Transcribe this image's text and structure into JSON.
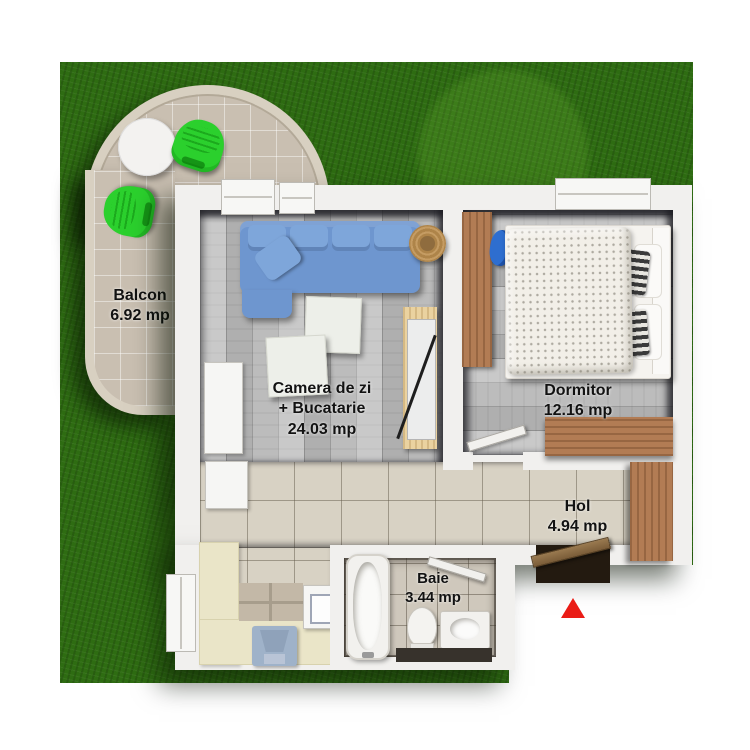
{
  "page": {
    "background": "#ffffff",
    "kind": "apartment floor plan, top-down render"
  },
  "rooms": {
    "balcon": {
      "label": "Balcon",
      "area": "6.92 mp"
    },
    "living": {
      "label_line1": "Camera de zi",
      "label_line2": "+ Bucatarie",
      "area": "24.03 mp"
    },
    "dormitor": {
      "label": "Dormitor",
      "area": "12.16 mp"
    },
    "hol": {
      "label": "Hol",
      "area": "4.94 mp"
    },
    "baie": {
      "label": "Baie",
      "area": "3.44 mp"
    }
  },
  "colors": {
    "grass": "#2e6c12",
    "balcony_tile": "#c9bfb1",
    "wall": "#f1f0ee",
    "wood_floor": "#bcbcbc",
    "tile_floor": "#d8d2c4",
    "bath_tile": "#cfc8bc",
    "kitchen_counter": "#eae5c8",
    "sofa_blue": "#6e96cf",
    "balcony_chair_green": "#2bd02d",
    "furniture_wood": "#b27c54",
    "desk_chair_blue": "#2e6ecf",
    "north_arrow_red": "#ea1c16"
  },
  "icons": {
    "north_arrow": "north-arrow"
  }
}
